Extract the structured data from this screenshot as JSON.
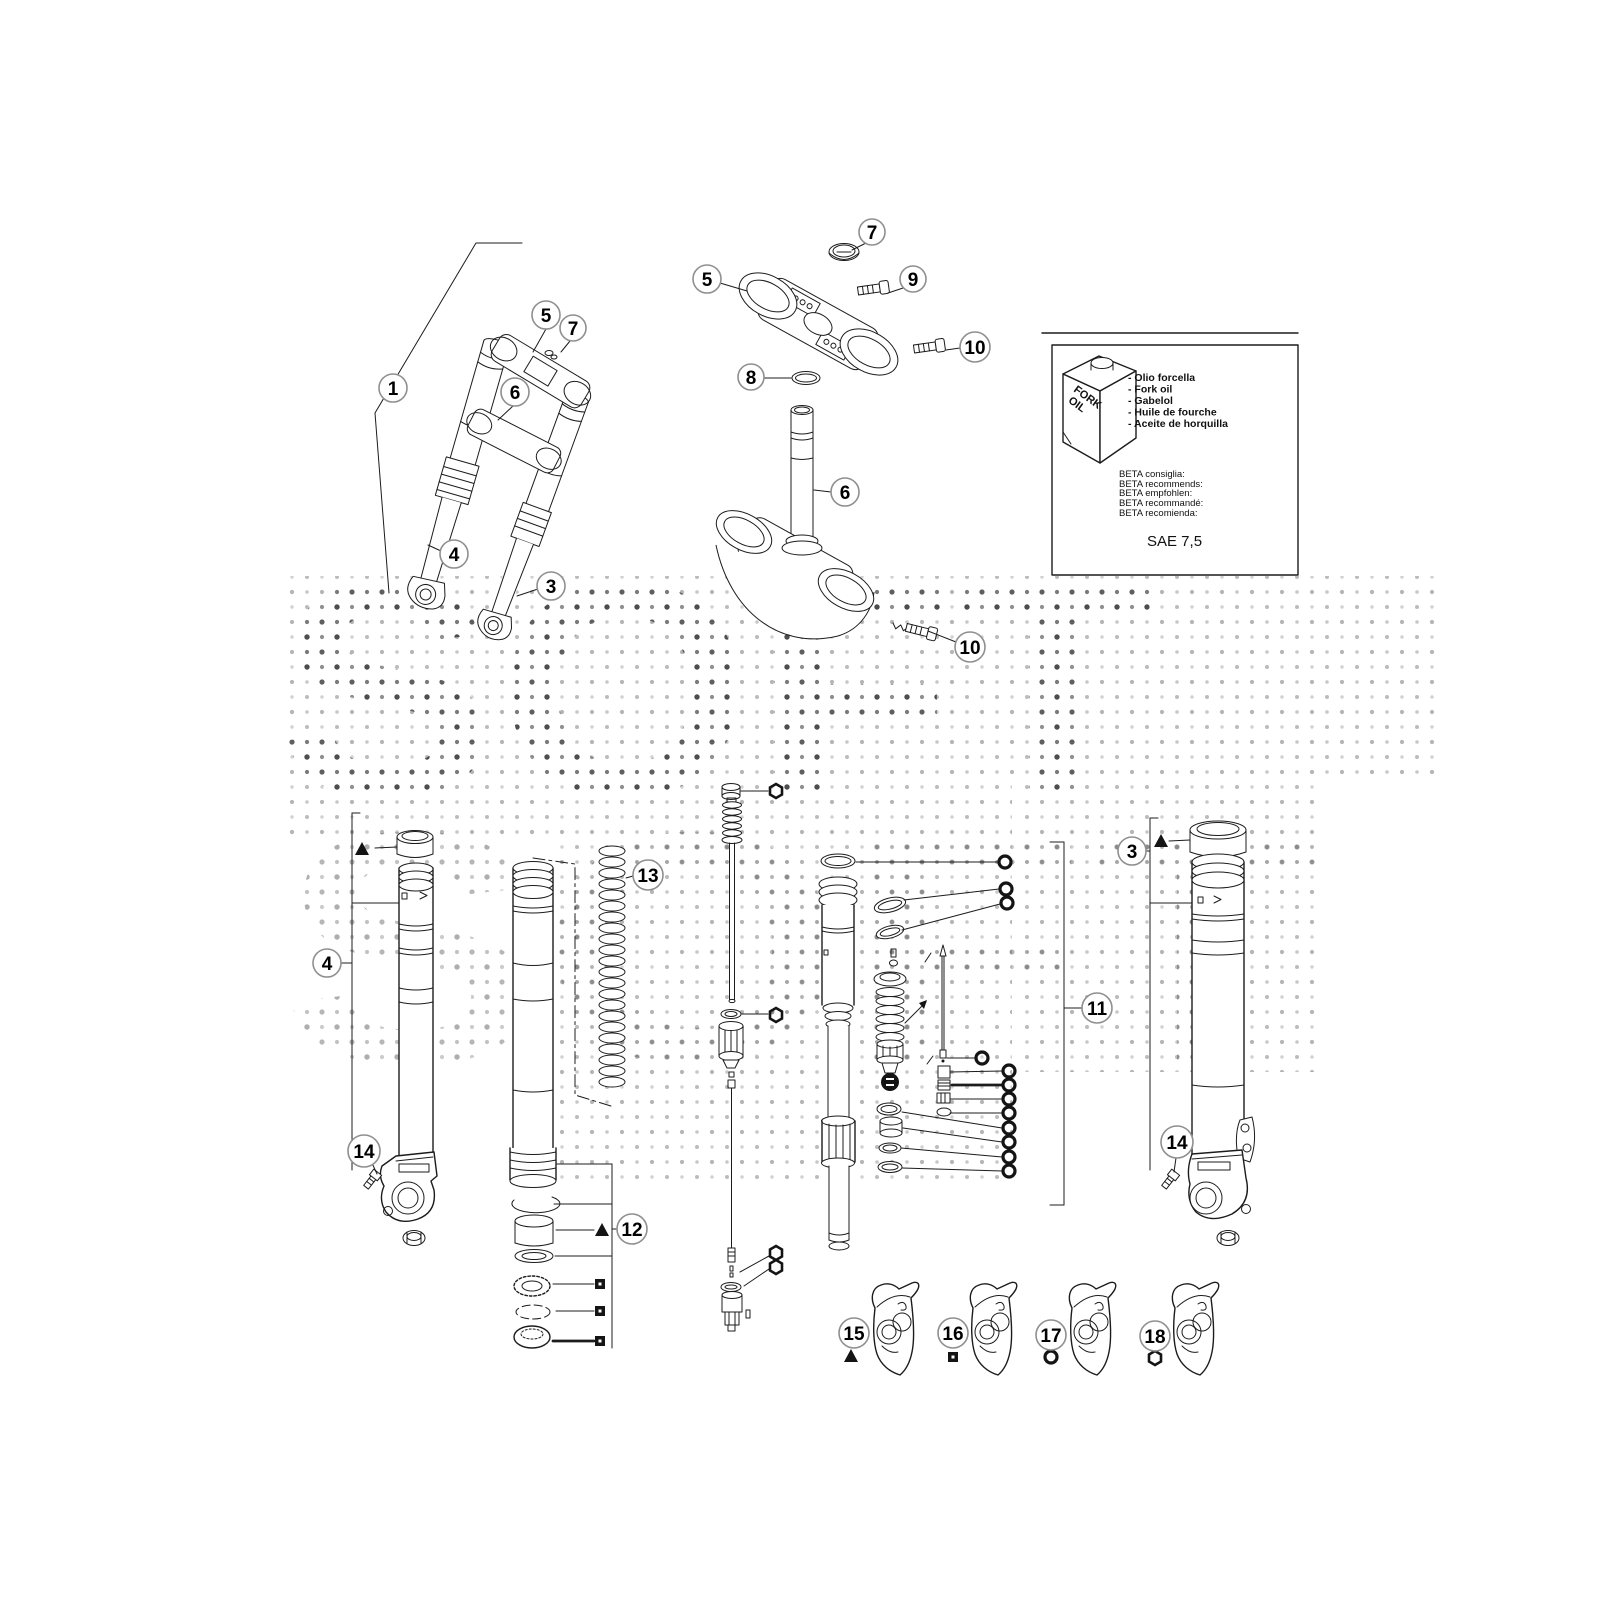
{
  "watermark": {
    "text": "SOFT"
  },
  "info_box": {
    "bottle": {
      "line1": "FORK",
      "line2": "OIL"
    },
    "oil_names": [
      "- Olio forcella",
      "- Fork oil",
      "- Gabelol",
      "- Huile de fourche",
      "- Aceite de horquilla"
    ],
    "recommendations": [
      "BETA consiglia:",
      "BETA recommends:",
      "BETA empfohlen:",
      "BETA recommandé:",
      "BETA recomienda:"
    ],
    "grade": "SAE 7,5"
  },
  "callouts": {
    "1": "1",
    "3": "3",
    "4": "4",
    "5": "5",
    "6": "6",
    "7": "7",
    "8": "8",
    "9": "9",
    "10": "10",
    "11": "11",
    "12": "12",
    "13": "13",
    "14": "14",
    "15": "15",
    "16": "16",
    "17": "17",
    "18": "18"
  }
}
